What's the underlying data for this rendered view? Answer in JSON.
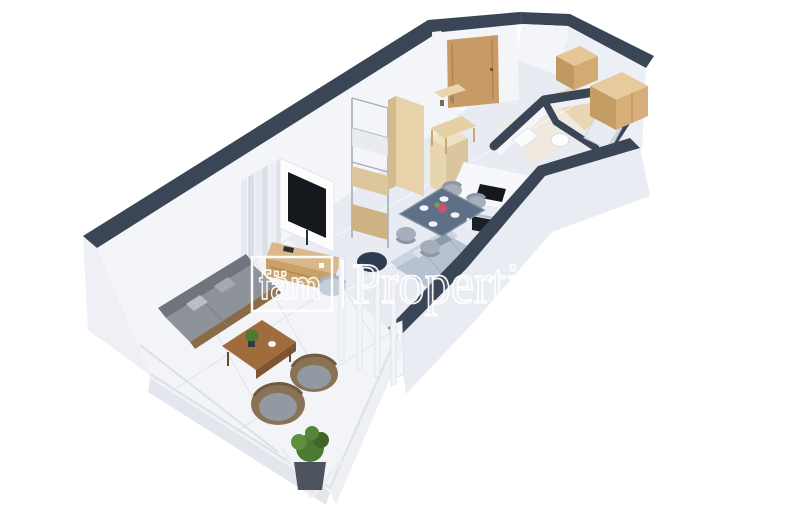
{
  "scene": {
    "kind": "isometric-3d-floor-plan-render",
    "background": "#ffffff"
  },
  "watermark": {
    "logo": "fäm",
    "wordmark": "Properties",
    "color": "#ffffff"
  },
  "palette": {
    "wall_top": "#3a4555",
    "wall_face": "#f4f5f9",
    "wall_face_shade": "#e9ecf3",
    "floor_interior": "#e9ebf3",
    "floor_balcony": "#f3f4f7",
    "floor_wood": "#e9d6b4",
    "door_wood": "#c89b66",
    "cabinet_wood": "#d9b98b",
    "wardrobe_wood": "#d6af7a",
    "kitchen_appliance": "#15181d",
    "dining_table": "#5e7086",
    "chair_gray": "#a6aebb",
    "sofa_indoor": "#b7c1cf",
    "sofa_outdoor": "#8e939b",
    "outdoor_table_wood": "#a06c3e",
    "wicker": "#8a7354",
    "plant_green": "#4d7a33",
    "pouf_navy": "#2e3b51"
  },
  "objects": [
    "balcony-terrace",
    "living-room",
    "dining-area",
    "kitchen",
    "entry-hall",
    "bathroom",
    "closet-room",
    "entry-door",
    "tv",
    "media-console",
    "curtains",
    "metal-shelving",
    "tall-cabinet",
    "console-table",
    "indoor-sofa",
    "pouf",
    "armchair",
    "dining-table",
    "dining-chairs",
    "cooktop",
    "oven",
    "outdoor-sofa",
    "outdoor-coffee-table",
    "wicker-chairs",
    "potted-plant",
    "glass-balustrade",
    "wardrobe"
  ]
}
